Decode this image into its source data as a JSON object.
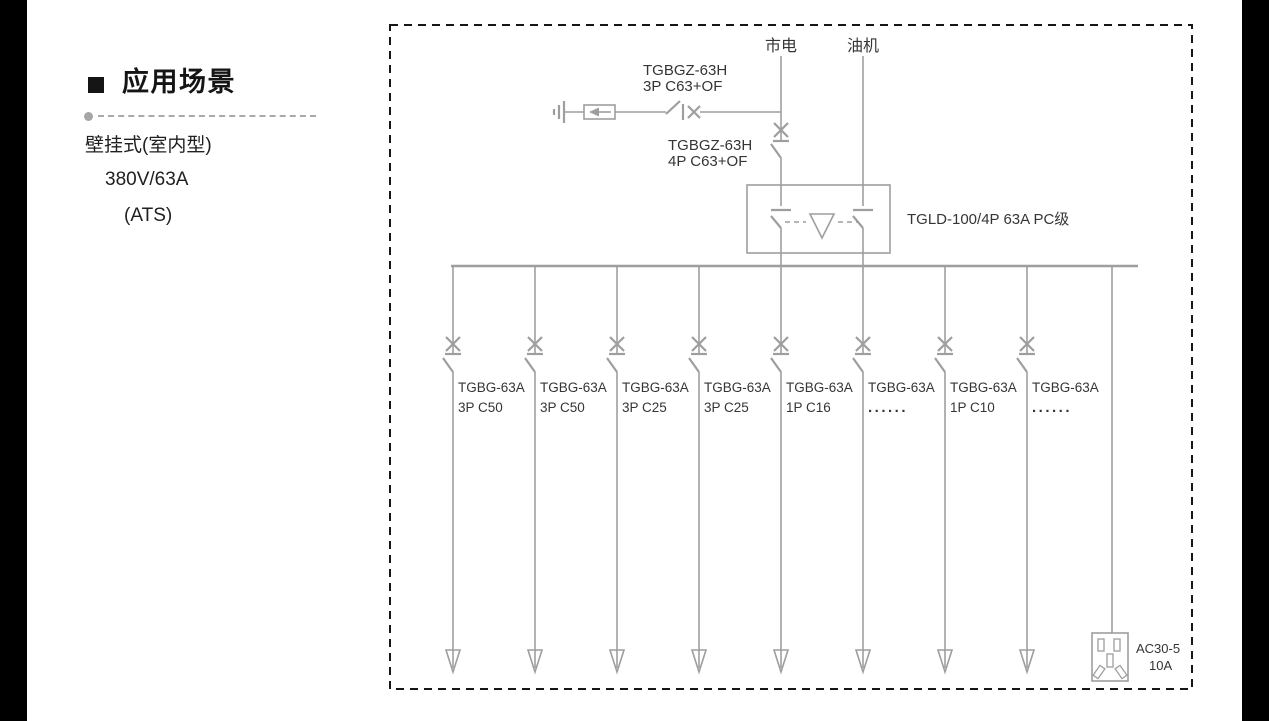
{
  "left_panel": {
    "heading": "应用场景",
    "specs": [
      "壁挂式(室内型)",
      "380V/63A",
      "(ATS)"
    ]
  },
  "diagram": {
    "sources": [
      {
        "label": "市电"
      },
      {
        "label": "油机"
      }
    ],
    "surge_branch": {
      "model": "TGBGZ-63H",
      "spec": "3P C63+OF"
    },
    "main_breaker": {
      "model": "TGBGZ-63H",
      "spec": "4P C63+OF"
    },
    "ats_label": "TGLD-100/4P 63A PC级",
    "branches": [
      {
        "model": "TGBG-63A",
        "spec": "3P C50"
      },
      {
        "model": "TGBG-63A",
        "spec": "3P C50"
      },
      {
        "model": "TGBG-63A",
        "spec": "3P C25"
      },
      {
        "model": "TGBG-63A",
        "spec": "3P C25"
      },
      {
        "model": "TGBG-63A",
        "spec": "1P C16"
      },
      {
        "model": "TGBG-63A",
        "spec": "......"
      },
      {
        "model": "TGBG-63A",
        "spec": "1P C10"
      },
      {
        "model": "TGBG-63A",
        "spec": "......"
      }
    ],
    "socket": {
      "model": "AC30-5",
      "rating": "10A"
    }
  },
  "colors": {
    "diagram_line": "#9e9e9e",
    "diagram_text": "#353535",
    "border_dash": "#161616",
    "letterbox": "#000000",
    "divider": "#a9a9a9"
  }
}
